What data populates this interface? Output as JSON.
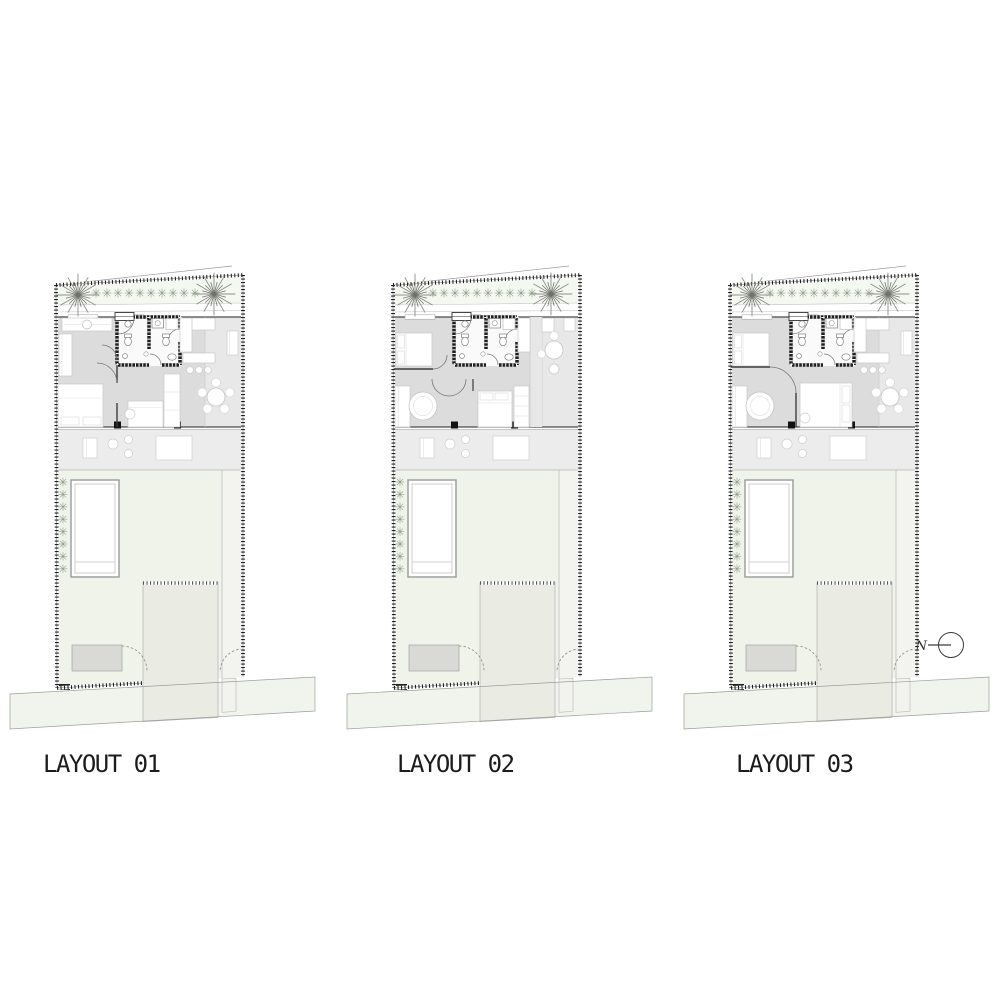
{
  "page": {
    "background": "#ffffff"
  },
  "panels": [
    {
      "id": "layout-01",
      "label": "LAYOUT 01"
    },
    {
      "id": "layout-02",
      "label": "LAYOUT 02"
    },
    {
      "id": "layout-03",
      "label": "LAYOUT 03"
    }
  ],
  "north_indicator": {
    "label": "N"
  },
  "colors": {
    "page_bg": "#ffffff",
    "label_text": "#1c1c1c",
    "house_gray": "#dcdcdc",
    "dining_gray": "#e8e8e8",
    "terrace_gray": "#ececec",
    "garden_green": "#f0f3ea",
    "road_green": "#f1f4ec",
    "hedge_green": "#f5f8f1",
    "wall_black": "#1f1f1f"
  }
}
